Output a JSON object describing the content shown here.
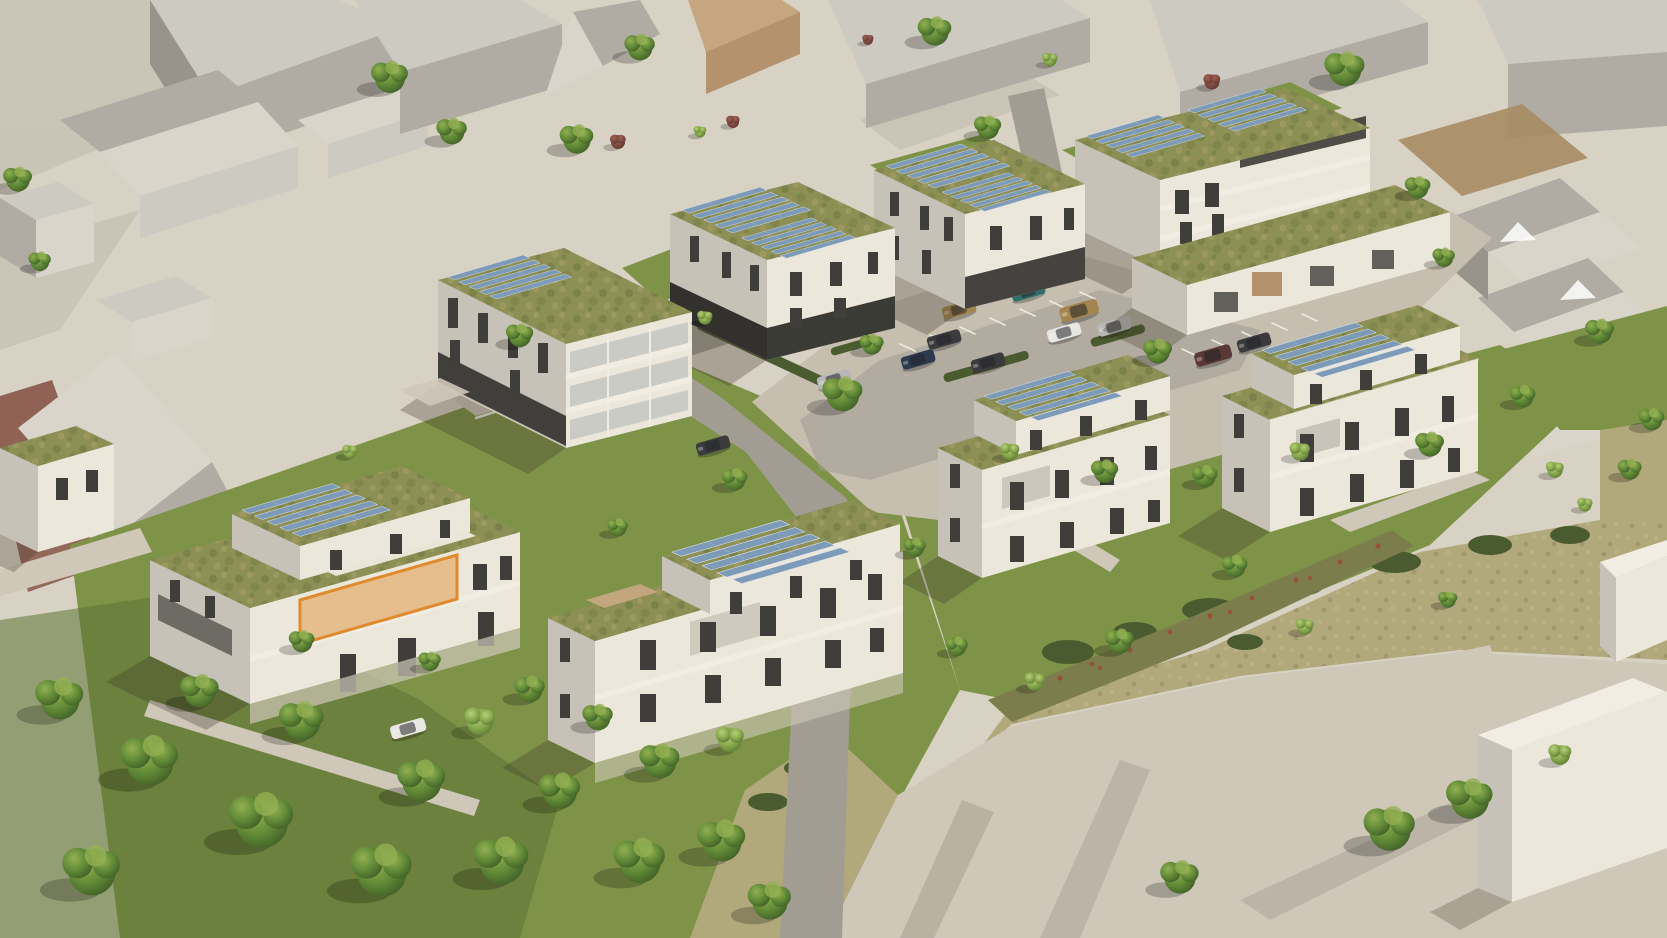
{
  "scene": {
    "type": "3d-aerial-architectural-rendering",
    "subject": "modern residential quarter with extensive green roofs and rooftop solar arrays, surrounded by untextured gray context massing buildings",
    "residential_buildings": 8,
    "parking_garage_buildings": 1,
    "highlighted_units": 1,
    "highlight": {
      "label": "highlighted-apartment",
      "building": "lower-left building, upper floor",
      "outline_color": "#e08a2e"
    }
  },
  "colors": {
    "plaza": "#d8d2c4",
    "plazaSh": "#beb8ab",
    "road": "#a29d93",
    "path": "#cfc8b9",
    "parking": "#c6bfb0",
    "stall": "#eeeae0",
    "ctxRoof": "#cdcac2",
    "ctxLit": "#d9d5cb",
    "ctxSh": "#b0aca3",
    "ctxDk": "#98948c",
    "tan": "#b3926d",
    "tanLit": "#c6a681",
    "brick": "#7e463a",
    "dirt": "#a78c64",
    "facadeLit": "#ece7db",
    "facadeShade": "#c7c2b7",
    "facadeDark": "#b2ada1",
    "plinth": "#32312d",
    "win": "#3f3e3a",
    "glass": "#99a3a6",
    "slab": "#f1ede3",
    "roofGreen": "#8d9055",
    "roofGreenDk": "#6c7840",
    "roofGreenLt": "#a89f67",
    "panel": "#7d9ab9",
    "panelLt": "#aabfd3",
    "grass": "#7f9348",
    "grassDk": "#5c7335",
    "meadow": "#b1a87b",
    "meadowLt": "#c3bb8d",
    "bush": "#4b5b30",
    "swale": "#7b7e4c",
    "flower": "#9a4a36",
    "shadow": "#3c3527",
    "orange": "#e08a2e",
    "carDark": "#3b3b3d",
    "carWhite": "#e9e7e2",
    "carSilver": "#b7b7b6",
    "carGold": "#a4854f",
    "carTeal": "#2f6f6a",
    "carMaroon": "#5a3836",
    "carBlue": "#2c3a4e"
  }
}
